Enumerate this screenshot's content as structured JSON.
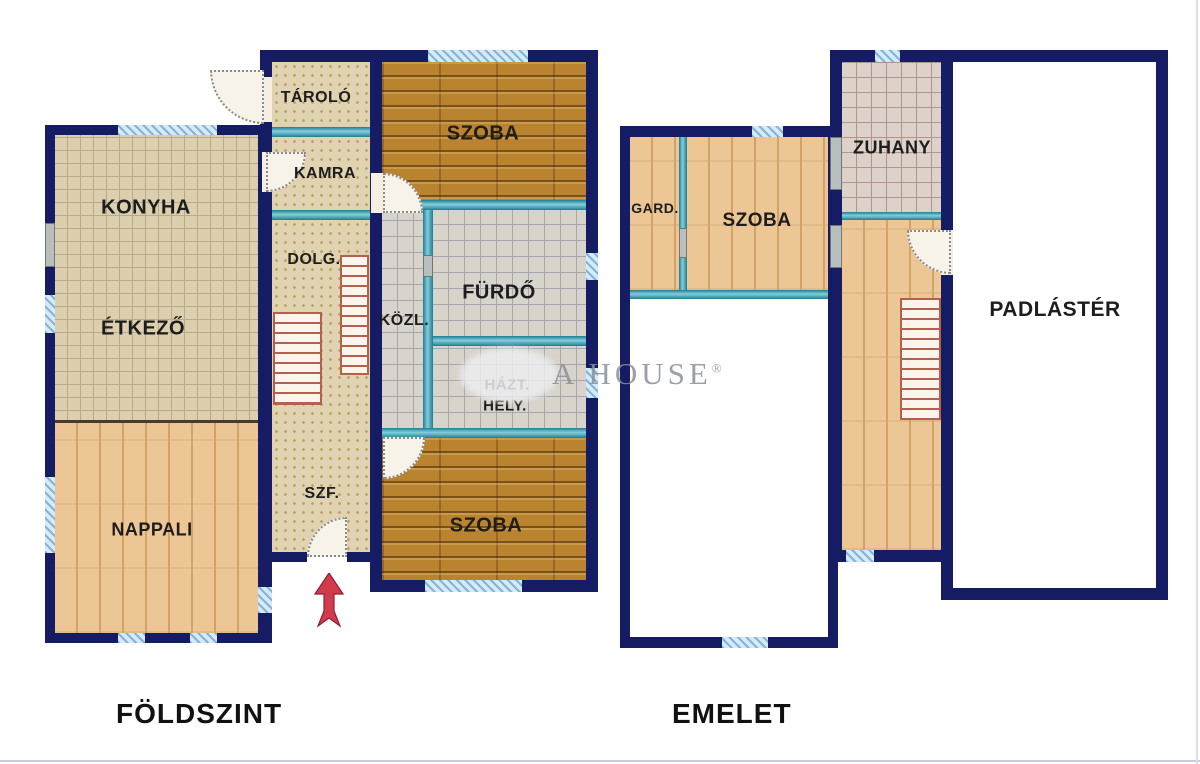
{
  "floors": {
    "ground": {
      "label": "FÖLDSZINT",
      "rooms": {
        "konyha": "KONYHA",
        "etkezo": "ÉTKEZŐ",
        "nappali": "NAPPALI",
        "tarolo": "TÁROLÓ",
        "kamra": "KAMRA",
        "dolg": "DOLG.",
        "szf": "SZF.",
        "szoba_top": "SZOBA",
        "furdo": "FÜRDŐ",
        "kozl": "KÖZL.",
        "hazt_line1": "HÁZT.",
        "hazt_line2": "HELY.",
        "szoba_bottom": "SZOBA"
      }
    },
    "upper": {
      "label": "EMELET",
      "rooms": {
        "gard": "GARD.",
        "szoba": "SZOBA",
        "zuhany": "ZUHANY",
        "padlaster": "PADLÁSTÉR"
      }
    }
  },
  "watermark": {
    "text": "A HOUSE",
    "reg": "®"
  },
  "colors": {
    "wall": "#161c63",
    "partition_teal": "#4aa3b8",
    "window_blue": "#d6eaf7",
    "tile_beige": "#dbcfae",
    "tile_gray": "#d8d3cb",
    "wood_light": "#ecc795",
    "wood_dark": "#b9832f",
    "arrow_red": "#d23a4e"
  }
}
